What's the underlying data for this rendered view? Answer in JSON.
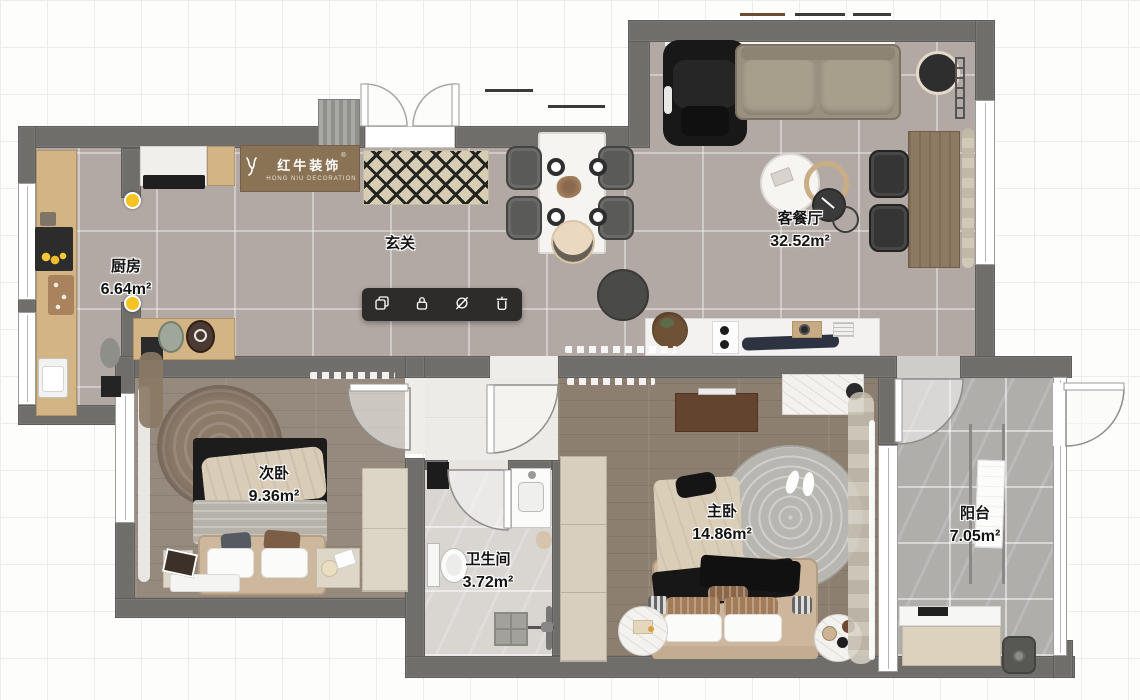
{
  "logo": {
    "brand": "红牛装饰",
    "subtitle": "HONG NIU DECORATION",
    "registered": "®"
  },
  "toolbar": {
    "items": [
      {
        "id": "duplicate",
        "icon": "copy-icon"
      },
      {
        "id": "lock",
        "icon": "lock-icon"
      },
      {
        "id": "hide",
        "icon": "eye-off-icon"
      },
      {
        "id": "delete",
        "icon": "trash-icon"
      }
    ]
  },
  "rooms": [
    {
      "id": "kitchen",
      "name": "厨房",
      "area": "6.64m²"
    },
    {
      "id": "entry",
      "name": "玄关",
      "area": ""
    },
    {
      "id": "living-dining",
      "name": "客餐厅",
      "area": "32.52m²"
    },
    {
      "id": "bedroom-2",
      "name": "次卧",
      "area": "9.36m²"
    },
    {
      "id": "master-bedroom",
      "name": "主卧",
      "area": "14.86m²"
    },
    {
      "id": "bathroom",
      "name": "卫生间",
      "area": "3.72m²"
    },
    {
      "id": "balcony",
      "name": "阳台",
      "area": "7.05m²"
    }
  ],
  "colors": {
    "wall": "#6f6e6b",
    "tile_floor": "#b3a9a4",
    "wood_floor": "#93897c",
    "bath_floor": "#dad7d3",
    "balcony_floor": "#b0aeab",
    "toolbar_bg": "#2d2c2a",
    "light_marker": "#f3c320"
  }
}
